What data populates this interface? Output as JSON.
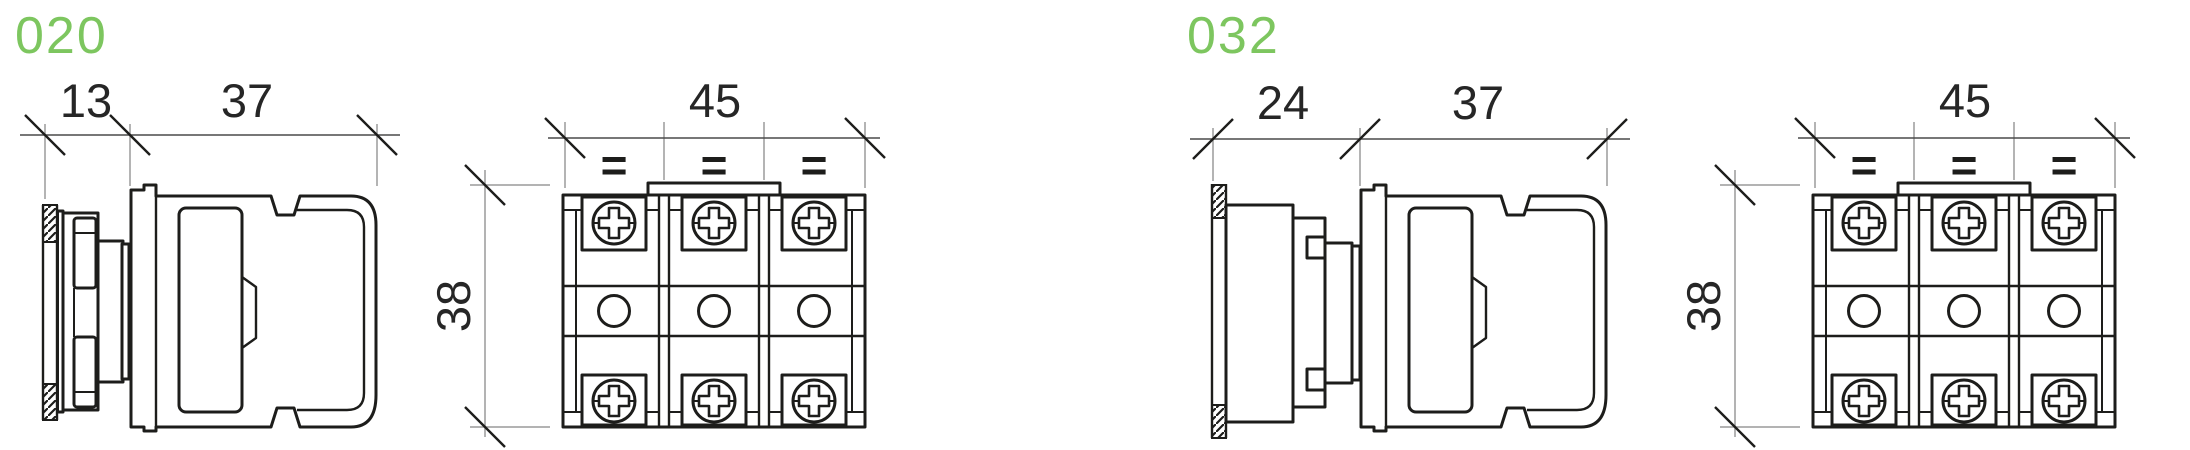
{
  "page": {
    "background": "#ffffff",
    "accent_color": "#7dc65f",
    "line_color": "#1d1d1b",
    "dimension_line_color": "#4a4a4a",
    "extension_line_color": "#9a9a9a"
  },
  "figures": [
    {
      "label": "020",
      "side_view": {
        "depth_mm": "13",
        "body_length_mm": "37"
      },
      "front_view": {
        "width_mm": "45",
        "height_mm": "38",
        "terminal_marks": [
          "=",
          "=",
          "="
        ]
      }
    },
    {
      "label": "032",
      "side_view": {
        "depth_mm": "24",
        "body_length_mm": "37"
      },
      "front_view": {
        "width_mm": "45",
        "height_mm": "38",
        "terminal_marks": [
          "=",
          "=",
          "="
        ]
      }
    }
  ]
}
